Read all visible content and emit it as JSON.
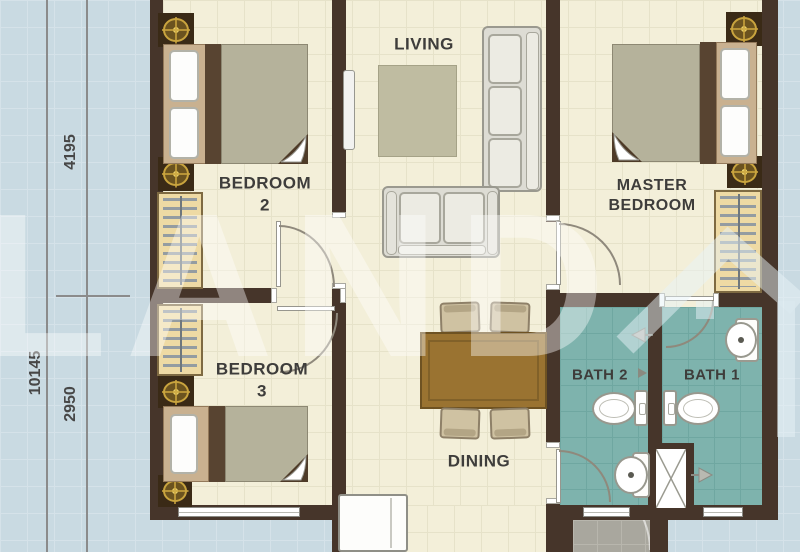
{
  "plan_title": "3-bedroom unit floor plan",
  "rooms": {
    "living": {
      "label": "LIVING"
    },
    "master": {
      "line1": "MASTER",
      "line2": "BEDROOM"
    },
    "bedroom2": {
      "line1": "BEDROOM",
      "line2": "2"
    },
    "bedroom3": {
      "line1": "BEDROOM",
      "line2": "3"
    },
    "dining": {
      "label": "DINING"
    },
    "bath1": {
      "label": "BATH 1"
    },
    "bath2": {
      "label": "BATH 2"
    }
  },
  "dimensions": {
    "total": "10145",
    "upper": "4195",
    "lower": "2950"
  },
  "watermark": {
    "text": "LAND"
  },
  "colors": {
    "wall": "#46352a",
    "floor": "#f3efd9",
    "bath_floor": "#7eb3ad",
    "outside": "#c9dae2",
    "wood": "#9a7331",
    "gold": "#c9a43e"
  }
}
